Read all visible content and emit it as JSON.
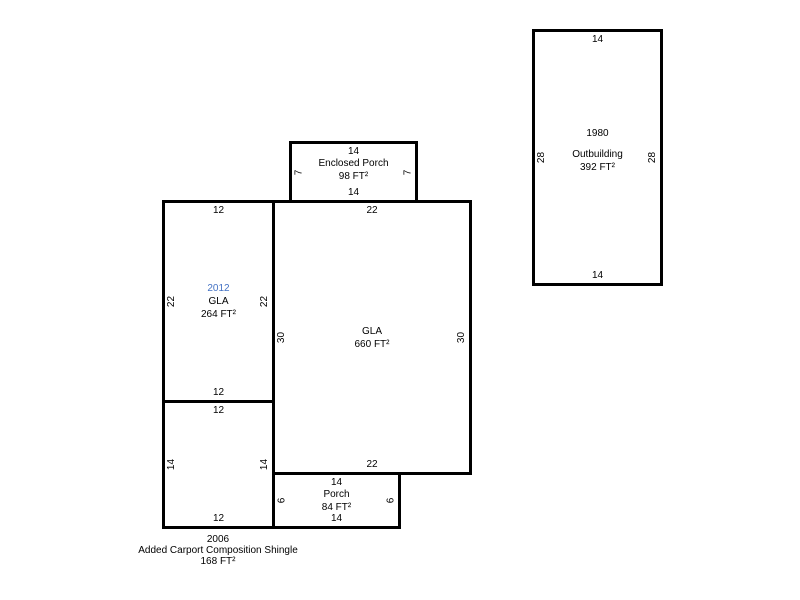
{
  "colors": {
    "background": "#ffffff",
    "wall": "#000000",
    "text": "#000000",
    "highlight_year": "#4472c4"
  },
  "shapes": {
    "outbuilding": {
      "year": "1980",
      "name": "Outbuilding",
      "area": "392 FT²",
      "dims": {
        "top": "14",
        "right": "28",
        "bottom": "14",
        "left": "28"
      }
    },
    "enclosed_porch": {
      "name": "Enclosed Porch",
      "area": "98 FT²",
      "dims": {
        "top": "14",
        "right": "7",
        "bottom": "14",
        "left": "7"
      }
    },
    "addition_2012": {
      "year": "2012",
      "year_style": "color:#4472c4",
      "name": "GLA",
      "area": "264 FT²",
      "dims": {
        "top": "12",
        "right": "22",
        "bottom": "12",
        "left": "22"
      }
    },
    "main_gla": {
      "name": "GLA",
      "area": "660 FT²",
      "dims": {
        "top": "22",
        "right": "30",
        "bottom": "22",
        "left": "30"
      }
    },
    "carport": {
      "dims": {
        "top": "12",
        "right": "14",
        "bottom": "12",
        "left": "14"
      },
      "caption": {
        "year": "2006",
        "name": "Added Carport Composition Shingle",
        "area": "168 FT²"
      }
    },
    "porch": {
      "name": "Porch",
      "area": "84 FT²",
      "dims": {
        "top": "14",
        "right": "6",
        "bottom": "14",
        "left": "6"
      }
    }
  }
}
